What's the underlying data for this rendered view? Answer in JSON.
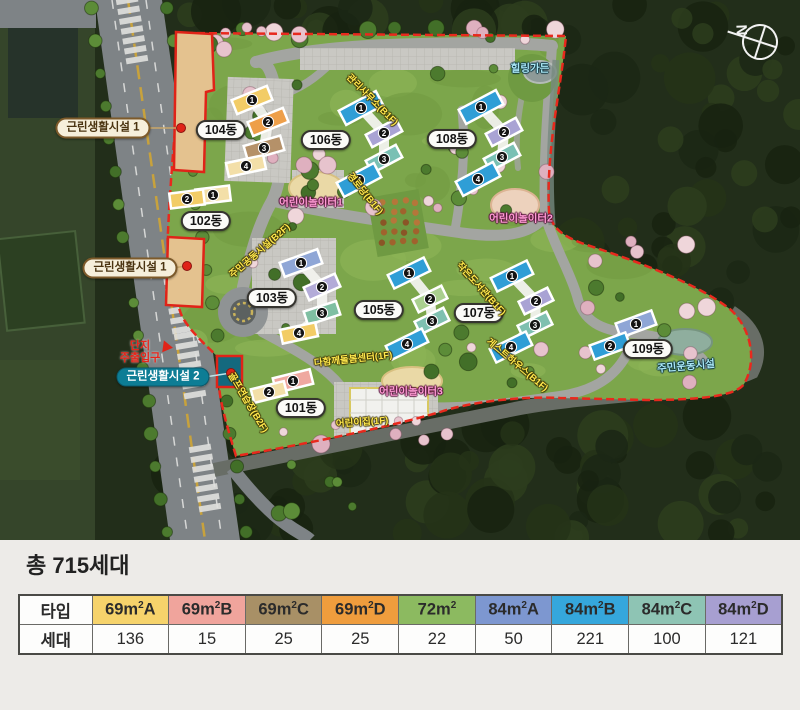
{
  "map": {
    "compass": {
      "label": "N"
    },
    "entrance": {
      "line1": "단지",
      "line2": "주출입구",
      "x": 140,
      "y": 352,
      "tri_x": 168,
      "tri_y": 347
    },
    "building_labels": [
      {
        "text": "101동",
        "x": 301,
        "y": 408
      },
      {
        "text": "102동",
        "x": 206,
        "y": 221
      },
      {
        "text": "103동",
        "x": 272,
        "y": 298
      },
      {
        "text": "104동",
        "x": 221,
        "y": 130
      },
      {
        "text": "105동",
        "x": 379,
        "y": 310
      },
      {
        "text": "106동",
        "x": 326,
        "y": 140
      },
      {
        "text": "107동",
        "x": 479,
        "y": 313
      },
      {
        "text": "108동",
        "x": 452,
        "y": 139
      },
      {
        "text": "109동",
        "x": 648,
        "y": 349
      }
    ],
    "facility_pills": [
      {
        "text": "근린생활시설 1",
        "x": 103,
        "y": 128,
        "style": "tan",
        "dot_x": 181,
        "dot_y": 128
      },
      {
        "text": "근린생활시설 1",
        "x": 130,
        "y": 268,
        "style": "tan",
        "dot_x": 187,
        "dot_y": 266
      },
      {
        "text": "근린생활시설 2",
        "x": 163,
        "y": 377,
        "style": "teal",
        "dot_x": 231,
        "dot_y": 373
      }
    ],
    "amenity_labels": [
      {
        "text": "관리사무소(B1F)",
        "x": 373,
        "y": 99,
        "rot": 45,
        "color": "yellow"
      },
      {
        "text": "경로당(B1F)",
        "x": 366,
        "y": 193,
        "rot": 51,
        "color": "yellow"
      },
      {
        "text": "주민공동시설(B2F)",
        "x": 259,
        "y": 250,
        "rot": -41,
        "color": "yellow"
      },
      {
        "text": "골프연습장(B2F)",
        "x": 249,
        "y": 402,
        "rot": 59,
        "color": "yellow"
      },
      {
        "text": "작은도서관(B1F)",
        "x": 482,
        "y": 288,
        "rot": 48,
        "color": "yellow"
      },
      {
        "text": "게스트하우스(B1F)",
        "x": 518,
        "y": 364,
        "rot": 40,
        "color": "yellow"
      },
      {
        "text": "다함께돌봄센터(1F)",
        "x": 353,
        "y": 358,
        "rot": -6,
        "color": "yellow"
      },
      {
        "text": "어린이집(1F)",
        "x": 362,
        "y": 421,
        "rot": -4,
        "color": "yellow"
      },
      {
        "text": "어린이놀이터1",
        "x": 311,
        "y": 202,
        "rot": 0,
        "color": "pink"
      },
      {
        "text": "어린이놀이터2",
        "x": 521,
        "y": 218,
        "rot": 0,
        "color": "pink"
      },
      {
        "text": "어린이놀이터3",
        "x": 411,
        "y": 391,
        "rot": 0,
        "color": "pink"
      },
      {
        "text": "힐링가든",
        "x": 530,
        "y": 68,
        "rot": 0,
        "color": "blue"
      },
      {
        "text": "주민운동시설",
        "x": 686,
        "y": 366,
        "rot": -5,
        "color": "blue"
      }
    ],
    "buildings": [
      {
        "name": "101동",
        "segs": [
          {
            "x": 293,
            "y": 381,
            "w": 38,
            "h": 15,
            "r": -14,
            "c": "#efa8a0",
            "n": 1
          },
          {
            "x": 269,
            "y": 392,
            "w": 34,
            "h": 14,
            "r": -14,
            "c": "#f3dfa8",
            "n": 2
          }
        ]
      },
      {
        "name": "102동",
        "segs": [
          {
            "x": 213,
            "y": 195,
            "w": 34,
            "h": 15,
            "r": -7,
            "c": "#f3dfa8",
            "n": 1
          },
          {
            "x": 187,
            "y": 199,
            "w": 34,
            "h": 15,
            "r": -7,
            "c": "#f2cc66",
            "n": 2
          }
        ]
      },
      {
        "name": "103동",
        "segs": [
          {
            "x": 301,
            "y": 263,
            "w": 40,
            "h": 15,
            "r": -20,
            "c": "#8fa6d6",
            "n": 1
          },
          {
            "x": 322,
            "y": 287,
            "w": 34,
            "h": 14,
            "r": -24,
            "c": "#b3abd8",
            "n": 2
          },
          {
            "x": 322,
            "y": 313,
            "w": 34,
            "h": 14,
            "r": -18,
            "c": "#7fbfa2",
            "n": 3
          },
          {
            "x": 299,
            "y": 333,
            "w": 36,
            "h": 14,
            "r": -12,
            "c": "#f2cc66",
            "n": 4
          }
        ]
      },
      {
        "name": "104동",
        "segs": [
          {
            "x": 252,
            "y": 100,
            "w": 38,
            "h": 15,
            "r": -22,
            "c": "#f2cc66",
            "n": 1
          },
          {
            "x": 268,
            "y": 122,
            "w": 38,
            "h": 15,
            "r": -22,
            "c": "#ee9f49",
            "n": 2
          },
          {
            "x": 264,
            "y": 148,
            "w": 38,
            "h": 15,
            "r": -16,
            "c": "#b59169",
            "n": 3
          },
          {
            "x": 246,
            "y": 166,
            "w": 38,
            "h": 14,
            "r": -12,
            "c": "#f3dfa8",
            "n": 4
          }
        ]
      },
      {
        "name": "105동",
        "segs": [
          {
            "x": 409,
            "y": 273,
            "w": 40,
            "h": 15,
            "r": -26,
            "c": "#2f9ed6",
            "n": 1
          },
          {
            "x": 430,
            "y": 299,
            "w": 32,
            "h": 14,
            "r": -26,
            "c": "#a9cf8e",
            "n": 2
          },
          {
            "x": 432,
            "y": 321,
            "w": 32,
            "h": 14,
            "r": -26,
            "c": "#7fc0b0",
            "n": 3
          },
          {
            "x": 407,
            "y": 344,
            "w": 40,
            "h": 15,
            "r": -26,
            "c": "#2f9ed6",
            "n": 4
          }
        ]
      },
      {
        "name": "106동",
        "segs": [
          {
            "x": 361,
            "y": 108,
            "w": 42,
            "h": 16,
            "r": -28,
            "c": "#2f9ed6",
            "n": 1
          },
          {
            "x": 384,
            "y": 133,
            "w": 34,
            "h": 14,
            "r": -28,
            "c": "#a9a3d4",
            "n": 2
          },
          {
            "x": 384,
            "y": 159,
            "w": 34,
            "h": 14,
            "r": -28,
            "c": "#79c0b4",
            "n": 3
          },
          {
            "x": 359,
            "y": 180,
            "w": 42,
            "h": 16,
            "r": -28,
            "c": "#2f9ed6",
            "n": 4
          }
        ]
      },
      {
        "name": "107동",
        "segs": [
          {
            "x": 512,
            "y": 276,
            "w": 40,
            "h": 15,
            "r": -26,
            "c": "#2f9ed6",
            "n": 1
          },
          {
            "x": 536,
            "y": 301,
            "w": 32,
            "h": 14,
            "r": -26,
            "c": "#a9a3d4",
            "n": 2
          },
          {
            "x": 535,
            "y": 325,
            "w": 32,
            "h": 14,
            "r": -26,
            "c": "#7fc0b0",
            "n": 3
          },
          {
            "x": 511,
            "y": 347,
            "w": 40,
            "h": 15,
            "r": -26,
            "c": "#2f9ed6",
            "n": 4
          }
        ]
      },
      {
        "name": "108동",
        "segs": [
          {
            "x": 481,
            "y": 107,
            "w": 42,
            "h": 16,
            "r": -28,
            "c": "#2f9ed6",
            "n": 1
          },
          {
            "x": 504,
            "y": 132,
            "w": 34,
            "h": 14,
            "r": -28,
            "c": "#a9a3d4",
            "n": 2
          },
          {
            "x": 502,
            "y": 157,
            "w": 34,
            "h": 14,
            "r": -28,
            "c": "#79c0b4",
            "n": 3
          },
          {
            "x": 478,
            "y": 179,
            "w": 42,
            "h": 16,
            "r": -28,
            "c": "#2f9ed6",
            "n": 4
          }
        ]
      },
      {
        "name": "109동",
        "segs": [
          {
            "x": 636,
            "y": 324,
            "w": 38,
            "h": 15,
            "r": -20,
            "c": "#8fa6d6",
            "n": 1
          },
          {
            "x": 610,
            "y": 346,
            "w": 38,
            "h": 15,
            "r": -20,
            "c": "#2f9ed6",
            "n": 2
          }
        ]
      }
    ]
  },
  "summary": {
    "total_label": "총 715세대",
    "table": {
      "row_headers": [
        "타입",
        "세대"
      ],
      "columns": [
        {
          "type": "69m²A",
          "count": "136",
          "color": "#f6d36b"
        },
        {
          "type": "69m²B",
          "count": "15",
          "color": "#f0a49c"
        },
        {
          "type": "69m²C",
          "count": "25",
          "color": "#a89066"
        },
        {
          "type": "69m²D",
          "count": "25",
          "color": "#ef9d3d"
        },
        {
          "type": "72m²",
          "count": "22",
          "color": "#8cba60"
        },
        {
          "type": "84m²A",
          "count": "50",
          "color": "#7d97d0"
        },
        {
          "type": "84m²B",
          "count": "221",
          "color": "#35a7dc"
        },
        {
          "type": "84m²C",
          "count": "100",
          "color": "#8ec4b4"
        },
        {
          "type": "84m²D",
          "count": "121",
          "color": "#a79fd1"
        }
      ]
    }
  }
}
